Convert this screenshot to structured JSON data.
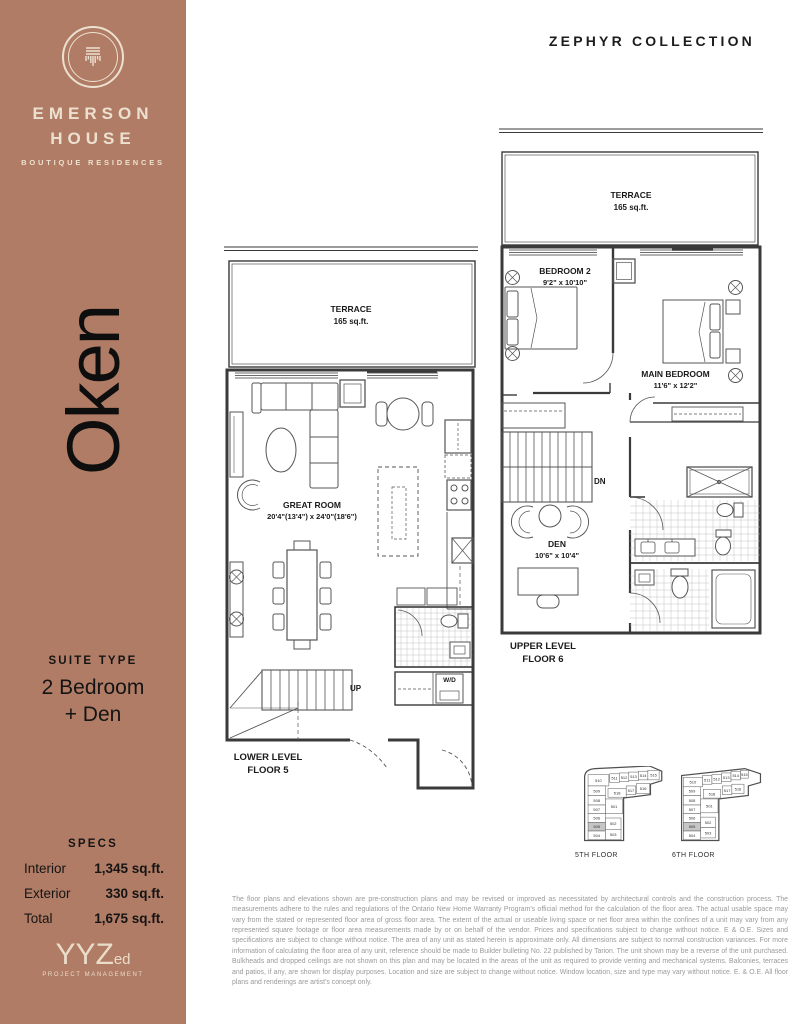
{
  "colors": {
    "accent": "#b17c65",
    "cream": "#ece1d0",
    "ink": "#141414",
    "keyplan_highlight": "#c6c6c6"
  },
  "header": {
    "collection": "ZEPHYR COLLECTION"
  },
  "sidebar": {
    "brand": {
      "line1": "EMERSON",
      "line2": "HOUSE",
      "tagline": "BOUTIQUE RESIDENCES"
    },
    "suite_name": "Oken",
    "suite_type_label": "SUITE TYPE",
    "suite_type_line1": "2 Bedroom",
    "suite_type_line2": "+ Den",
    "specs_label": "SPECS",
    "specs": [
      {
        "label": "Interior",
        "value": "1,345 sq.ft."
      },
      {
        "label": "Exterior",
        "value": "330 sq.ft."
      },
      {
        "label": "Total",
        "value": "1,675 sq.ft."
      }
    ],
    "developer": {
      "abbr": "YYZ",
      "suffix": "ed",
      "sub": "PROJECT MANAGEMENT"
    }
  },
  "plans": {
    "lower": {
      "terrace_name": "TERRACE",
      "terrace_area": "165 sq.ft.",
      "room_name": "GREAT ROOM",
      "room_dims": "20'4\"(13'4\") x 24'0\"(18'6\")",
      "stair_label": "UP",
      "laundry_label": "W/D",
      "level_line1": "LOWER LEVEL",
      "level_line2": "FLOOR 5"
    },
    "upper": {
      "terrace_name": "TERRACE",
      "terrace_area": "165 sq.ft.",
      "bedroom2_name": "BEDROOM 2",
      "bedroom2_dims": "9'2\" x 10'10\"",
      "main_bedroom_name": "MAIN BEDROOM",
      "main_bedroom_dims": "11'6\" x 12'2\"",
      "den_name": "DEN",
      "den_dims": "10'6\" x 10'4\"",
      "stair_label": "DN",
      "level_line1": "UPPER LEVEL",
      "level_line2": "FLOOR 6"
    }
  },
  "keyplans": [
    {
      "caption": "5TH FLOOR",
      "units": [
        {
          "label": "510",
          "x": 7,
          "y": 10,
          "w": 24,
          "h": 13,
          "hl": false
        },
        {
          "label": "511",
          "x": 32,
          "y": 9,
          "w": 11,
          "h": 10,
          "hl": false
        },
        {
          "label": "512",
          "x": 43,
          "y": 8,
          "w": 11,
          "h": 10,
          "hl": false
        },
        {
          "label": "513",
          "x": 54,
          "y": 7,
          "w": 11,
          "h": 10,
          "hl": false
        },
        {
          "label": "514",
          "x": 65,
          "y": 6,
          "w": 11,
          "h": 10,
          "hl": false
        },
        {
          "label": "515",
          "x": 76,
          "y": 5,
          "w": 13,
          "h": 11,
          "hl": false
        },
        {
          "label": "509",
          "x": 7,
          "y": 23,
          "w": 20,
          "h": 11,
          "hl": false
        },
        {
          "label": "518",
          "x": 30,
          "y": 26,
          "w": 21,
          "h": 10,
          "hl": false
        },
        {
          "label": "517",
          "x": 51,
          "y": 23,
          "w": 11,
          "h": 10,
          "hl": false
        },
        {
          "label": "516",
          "x": 63,
          "y": 20,
          "w": 15,
          "h": 12,
          "hl": false
        },
        {
          "label": "508",
          "x": 7,
          "y": 34,
          "w": 20,
          "h": 11,
          "hl": false
        },
        {
          "label": "501",
          "x": 27,
          "y": 38,
          "w": 20,
          "h": 17,
          "hl": false
        },
        {
          "label": "507",
          "x": 7,
          "y": 45,
          "w": 20,
          "h": 10,
          "hl": false
        },
        {
          "label": "506",
          "x": 7,
          "y": 55,
          "w": 20,
          "h": 10,
          "hl": false
        },
        {
          "label": "502",
          "x": 27,
          "y": 60,
          "w": 18,
          "h": 13,
          "hl": false
        },
        {
          "label": "505",
          "x": 7,
          "y": 65,
          "w": 20,
          "h": 10,
          "hl": true
        },
        {
          "label": "504",
          "x": 7,
          "y": 75,
          "w": 20,
          "h": 10,
          "hl": false
        },
        {
          "label": "503",
          "x": 27,
          "y": 73,
          "w": 18,
          "h": 12,
          "hl": false
        }
      ]
    },
    {
      "caption": "6TH FLOOR",
      "units": [
        {
          "label": "510",
          "x": 5,
          "y": 13,
          "w": 22,
          "h": 11,
          "hl": false
        },
        {
          "label": "511",
          "x": 27,
          "y": 11,
          "w": 11,
          "h": 10,
          "hl": false
        },
        {
          "label": "512",
          "x": 38,
          "y": 10,
          "w": 11,
          "h": 10,
          "hl": false
        },
        {
          "label": "513",
          "x": 49,
          "y": 8,
          "w": 11,
          "h": 10,
          "hl": false
        },
        {
          "label": "514",
          "x": 60,
          "y": 6,
          "w": 11,
          "h": 10,
          "hl": false
        },
        {
          "label": "515",
          "x": 71,
          "y": 5,
          "w": 9,
          "h": 9,
          "hl": false
        },
        {
          "label": "509",
          "x": 5,
          "y": 24,
          "w": 20,
          "h": 10,
          "hl": false
        },
        {
          "label": "518",
          "x": 28,
          "y": 27,
          "w": 20,
          "h": 10,
          "hl": false
        },
        {
          "label": "517",
          "x": 50,
          "y": 23,
          "w": 11,
          "h": 10,
          "hl": false
        },
        {
          "label": "516",
          "x": 61,
          "y": 21,
          "w": 14,
          "h": 11,
          "hl": false
        },
        {
          "label": "508",
          "x": 5,
          "y": 34,
          "w": 20,
          "h": 11,
          "hl": false
        },
        {
          "label": "501",
          "x": 25,
          "y": 38,
          "w": 20,
          "h": 16,
          "hl": false
        },
        {
          "label": "507",
          "x": 5,
          "y": 45,
          "w": 20,
          "h": 10,
          "hl": false
        },
        {
          "label": "506",
          "x": 5,
          "y": 55,
          "w": 20,
          "h": 10,
          "hl": false
        },
        {
          "label": "502",
          "x": 25,
          "y": 59,
          "w": 17,
          "h": 12,
          "hl": false
        },
        {
          "label": "505",
          "x": 5,
          "y": 65,
          "w": 20,
          "h": 10,
          "hl": true
        },
        {
          "label": "504",
          "x": 5,
          "y": 75,
          "w": 20,
          "h": 10,
          "hl": false
        },
        {
          "label": "503",
          "x": 25,
          "y": 71,
          "w": 17,
          "h": 12,
          "hl": false
        }
      ]
    }
  ],
  "disclaimer": "The floor plans and elevations shown are pre-construction plans and may be revised or improved as necessitated by architectural controls and the construction process. The measurements adhere to the rules and regulations of the Ontario New Home Warranty Program's official method for the calculation of the floor area. The actual usable space may vary from the stated or represented floor area of gross floor area. The extent of the actual or useable living space or net floor area within the confines of a unit may vary from any represented square footage or floor area measurements made by or on behalf of the vendor. Prices and specifications subject to change without notice. E & O.E. Sizes and specifications are subject to change without notice. The area of any unit as stated herein is approximate only. All dimensions are subject to normal construction variances. For more information of calculating the floor area of any unit, reference should be made to Builder bulleting No. 22 published by Tarion. The unit shown may be a reverse of the unit purchased. Bulkheads and dropped ceilings are not shown on this plan and may be located in the areas of the unit as required to provide venting and mechanical systems. Balconies, terraces and patios, if any, are shown for display purposes. Location and size are subject to change without notice. Window location, size and type may vary without notice. E. & O.E. All floor plans and renderings are artist's concept only."
}
